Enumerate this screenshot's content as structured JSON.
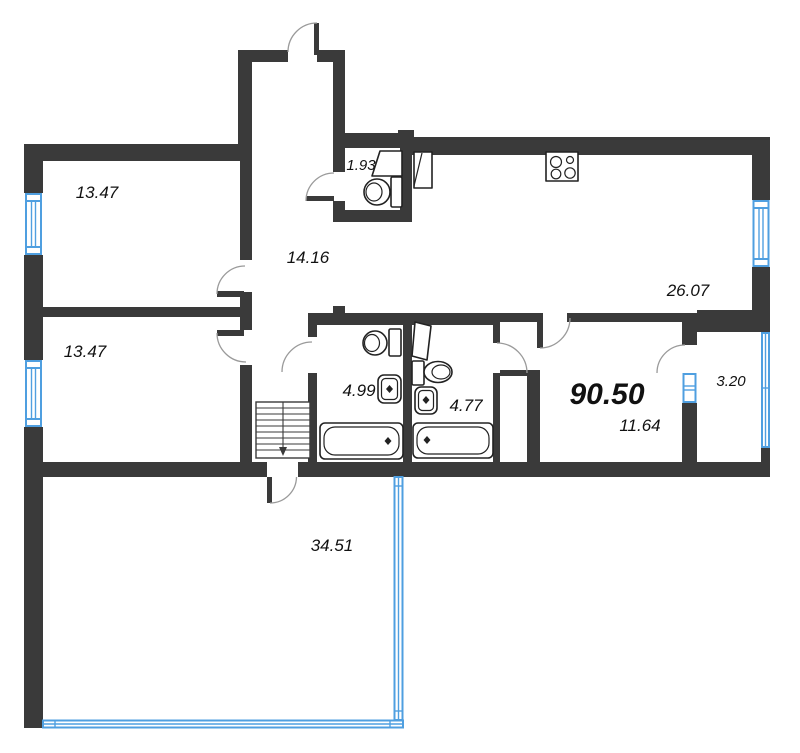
{
  "title": "apartment-floor-plan",
  "total_area": "90.50",
  "rooms": [
    {
      "id": "bedroom-upper-left",
      "area": "13.47"
    },
    {
      "id": "bedroom-lower-left",
      "area": "13.47"
    },
    {
      "id": "hallway",
      "area": "14.16"
    },
    {
      "id": "wc",
      "area": "1.93"
    },
    {
      "id": "kitchen-living-room",
      "area": "26.07"
    },
    {
      "id": "bathroom-left",
      "area": "4.99"
    },
    {
      "id": "bathroom-right",
      "area": "4.77"
    },
    {
      "id": "hall-corridor",
      "area": "11.64"
    },
    {
      "id": "balcony",
      "area": "3.20"
    },
    {
      "id": "terrace-room",
      "area": "34.51"
    }
  ],
  "colors": {
    "wall": "#3a3a3a",
    "window": "#4f9fe0",
    "fixture_outline": "#222222",
    "door_arc": "#9a9a9a",
    "label_text": "#111111",
    "background": "#ffffff"
  }
}
